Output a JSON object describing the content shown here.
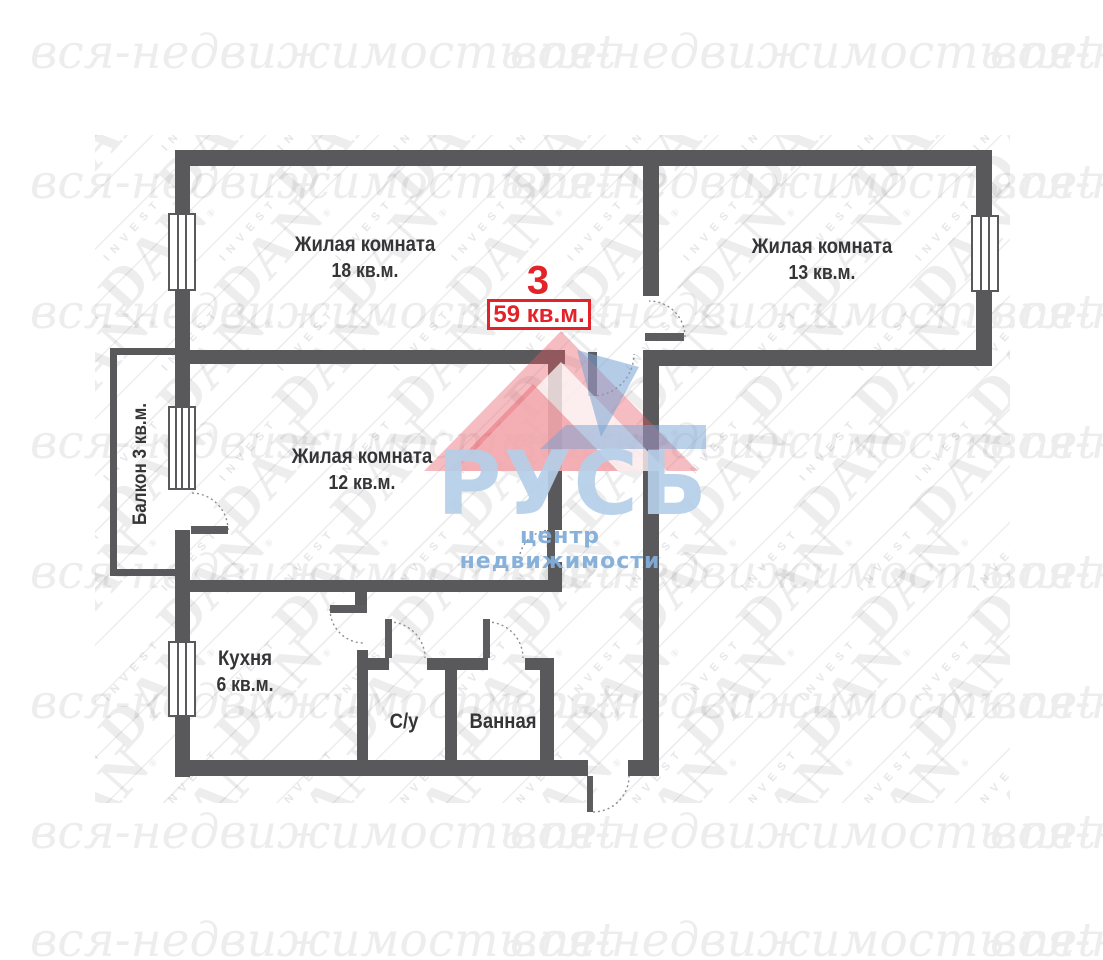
{
  "watermarks": {
    "script_text": "вся-недвижимость.net",
    "brand_text": "DAN",
    "brand_sub_text": "INVEST",
    "registered_mark": "®"
  },
  "logo": {
    "title": "РУСЬ",
    "subtitle": "центр недвижимости",
    "accent_blue": "#b5cfe9",
    "accent_pink": "#e85f6a"
  },
  "plan": {
    "flat_number": "3",
    "total_area": "59 кв.м.",
    "wall_color": "#59595b",
    "highlight_color": "#e2232a",
    "rooms": [
      {
        "name": "Жилая комната",
        "area": "18 кв.м."
      },
      {
        "name": "Жилая комната",
        "area": "13 кв.м."
      },
      {
        "name": "Жилая комната",
        "area": "12 кв.м."
      },
      {
        "name": "Кухня",
        "area": "6 кв.м."
      },
      {
        "name": "С/у",
        "area": ""
      },
      {
        "name": "Ванная",
        "area": ""
      },
      {
        "name": "Балкон 3 кв.м.",
        "area": ""
      }
    ]
  }
}
